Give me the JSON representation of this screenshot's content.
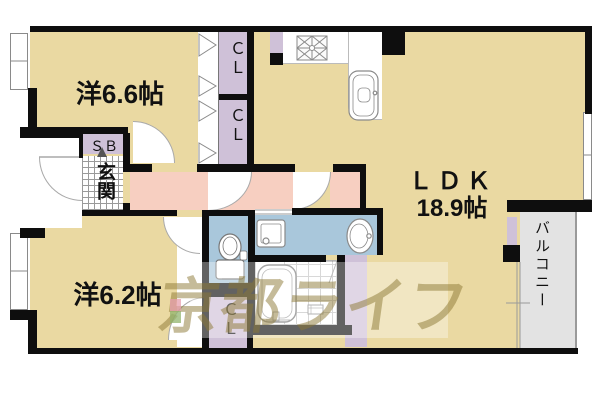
{
  "palette": {
    "floor_tan": "#ead9a2",
    "hall_pink": "#f7cfc1",
    "water_blue": "#a9c7db",
    "closet_lavender": "#cfc1d8",
    "balcony_gray": "#e3e3e3",
    "wall_black": "#0e0e0e",
    "watermark_khaki": "rgba(139,119,52,0.5)",
    "logo_pink": "#e79fae",
    "logo_green": "#92b46e"
  },
  "rooms": {
    "west_room_1": {
      "label": "洋6.6帖"
    },
    "west_room_2": {
      "label": "洋6.2帖"
    },
    "ldk": {
      "label": "ＬＤＫ",
      "size": "18.9帖"
    },
    "balcony": {
      "label": "バルコニー"
    },
    "entrance": {
      "label": "玄関"
    },
    "shoe_box": {
      "label": "ＳＢ"
    },
    "closet_top": {
      "label": "ＣＬ"
    },
    "closet_mid": {
      "label": "ＣＬ"
    },
    "closet_bottom": {
      "label": "ＣＬ"
    }
  },
  "fixtures": [
    "gas-stove",
    "kitchen-sink",
    "toilet",
    "washing-machine-pan",
    "washbasin-vanity",
    "bathtub",
    "shower-drain"
  ],
  "watermark": {
    "text": "京都ライフ"
  }
}
